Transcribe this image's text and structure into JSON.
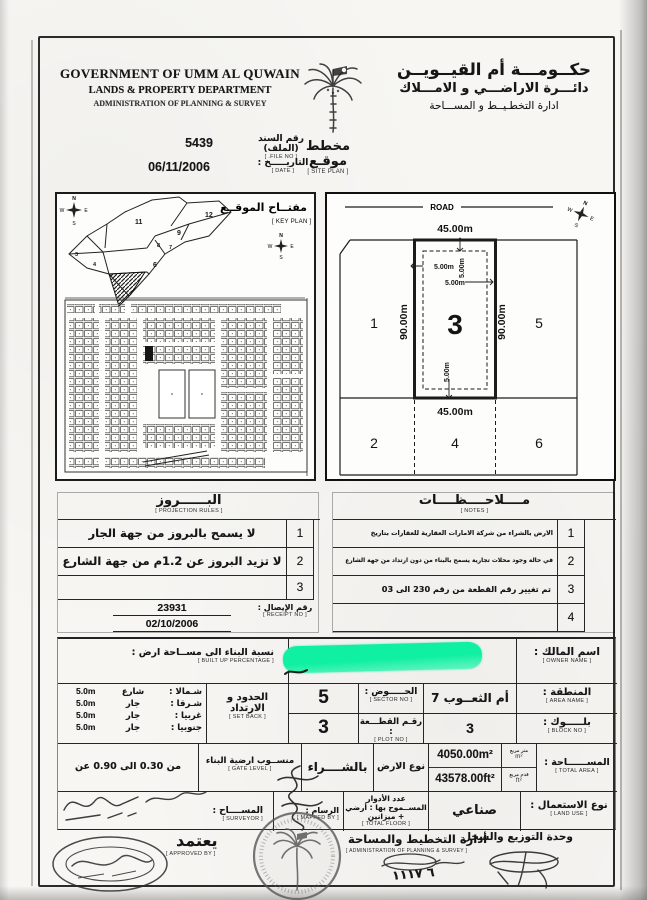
{
  "header": {
    "en1": "GOVERNMENT OF UMM AL QUWAIN",
    "en2": "LANDS & PROPERTY DEPARTMENT",
    "en3": "ADMINISTRATION OF PLANNING & SURVEY",
    "ar1": "حكــومـــة أم القيــويــن",
    "ar2": "دائـــرة الاراضـــي و الامـــلاك",
    "ar3": "ادارة التخطـيــط و المســـاحة"
  },
  "meta": {
    "title_ar": "مخطط موقـع",
    "title_en": "[ SITE PLAN ]",
    "file_label_ar": "رقم السند (الملف)",
    "file_label_en": "[ FILE NO. ]",
    "file_no": "5439",
    "date_label_ar": "التاريـــــخ :",
    "date_label_en": "[ DATE ]",
    "date": "06/11/2006"
  },
  "keyplan": {
    "title_ar": "مفتــاح الموقــع",
    "title_en": "[ KEY PLAN ]",
    "n": "N",
    "e": "E",
    "s": "S",
    "w": "W",
    "sectors": [
      "12",
      "11",
      "9",
      "8",
      "7",
      "6",
      "4",
      "3"
    ]
  },
  "siteplan": {
    "road": "ROAD",
    "dim_top": "45.00m",
    "dim_bottom": "45.00m",
    "dim_left": "90.00m",
    "dim_right": "90.00m",
    "sb": "5.00m",
    "plot": "3",
    "n1": "1",
    "n5": "5",
    "n2": "2",
    "n4": "4",
    "n6": "6"
  },
  "projection": {
    "title_ar": "البــــــروز",
    "title_en": "[ PROJECTION RULES ]",
    "rows": [
      {
        "no": "1",
        "text": "لا يسمح بالبروز من جهة الجار"
      },
      {
        "no": "2",
        "text": "لا تزيد البروز عن 1.2م من جهة الشارع"
      },
      {
        "no": "3",
        "text": ""
      }
    ],
    "receipt_label_ar": "رقم الإيصال :",
    "receipt_label_en": "[ RECEIPT NO ]",
    "receipt_no": "23931",
    "receipt_date": "02/10/2006"
  },
  "notes": {
    "title_ar": "مــــلاحــــظــــات",
    "title_en": "[ NOTES ]",
    "rows": [
      {
        "no": "1",
        "text": "الارض بالشراء من شركة الامارات العقارية للعقارات بتاريخ 03/10/2006"
      },
      {
        "no": "2",
        "text": "في حالة وجود محلات تجارية يسمح بالبناء من دون ارتداد من جهة الشارع فقط"
      },
      {
        "no": "3",
        "text": "تم تغيير رقم القطعة من رقم 230 الى 03"
      },
      {
        "no": "4",
        "text": ""
      }
    ]
  },
  "form": {
    "owner_label_ar": "اسم المالك :",
    "owner_label_en": "[ OWNER NAME ]",
    "builtup_label_ar": "نسبة البناء الى مســاحة ارض :",
    "builtup_label_en": "[ BUILT UP PERCENTAGE ]",
    "area_label_ar": "المنطقة :",
    "area_label_en": "[ AREA NAME ]",
    "area_value": "أم الثعــوب 7",
    "sector_label_ar": "الحـــــوض :",
    "sector_label_en": "[ SECTOR NO ]",
    "sector_value": "5",
    "block_label_ar": "بلـــــوك :",
    "block_label_en": "[ BLOCK NO ]",
    "block_value": "3",
    "plot_label_ar": "رقـم القطـــعة :",
    "plot_label_en": "[ PLOT NO ]",
    "plot_value": "3",
    "setback_label_ar1": "الحدود و",
    "setback_label_ar2": "الارتداد",
    "setback_label_en": "[ SET BACK ]",
    "setback_rows": [
      {
        "dir_ar": "شـمالا :",
        "dir_en": "[ NORTH ]",
        "type": "شارع",
        "val": "5.0m"
      },
      {
        "dir_ar": "شـرقا :",
        "dir_en": "[ EAST ]",
        "type": "جار",
        "val": "5.0m"
      },
      {
        "dir_ar": "غربيا :",
        "dir_en": "[ WEST ]",
        "type": "جار",
        "val": "5.0m"
      },
      {
        "dir_ar": "جنوبيا :",
        "dir_en": "[ SOUTH ]",
        "type": "جار",
        "val": "5.0m"
      }
    ],
    "area_total_label_ar": "المســــــاحة :",
    "area_total_label_en": "[ TOTAL AREA ]",
    "unit_m_ar": "متر مربع",
    "unit_m_en": "m²",
    "unit_ft_ar": "قدم مربع",
    "unit_ft_en": "ft²",
    "area_m2": "4050.00m²",
    "area_ft2": "43578.00ft²",
    "landtype_label_ar": "نوع الارض :",
    "landtype_value": "بالشــــراء",
    "gatelevel_label_ar": "منســوب ارضية البناء",
    "gatelevel_label_en": "[ GATE LEVEL ]",
    "gatelevel_value": "من 0.30 الى 0.90 عن الشارع",
    "landuse_label_ar": "نوع الاستعمال :",
    "landuse_label_en": "[ LAND USE ]",
    "landuse_value": "صناعي",
    "floors_label_ar1": "عدد الأدوار",
    "floors_label_ar2": "المســموح بها : أرضي + ميزانين",
    "floors_label_en": "[ TOTAL FLOOR ]",
    "mapped_label_ar": "الرسام :",
    "mapped_label_en": "[ MAPPED BY ]",
    "surveyor_label_ar": "المســــاح :",
    "surveyor_label_en": "[ SURVEYOR ]"
  },
  "footer": {
    "approved_ar": "يعتمد",
    "approved_en": "[ APPROVED BY ]",
    "admin_ar": "أدارة التخطيط والمساحة",
    "admin_en": "[ ADMINISTRATION OF PLANNING & SURVEY ]",
    "dist_ar": "وحدة التوزيع والسجل",
    "handwritten": "٦ ١١١٧"
  },
  "colors": {
    "redaction_green": "#10f0a2",
    "ink": "#161616"
  }
}
